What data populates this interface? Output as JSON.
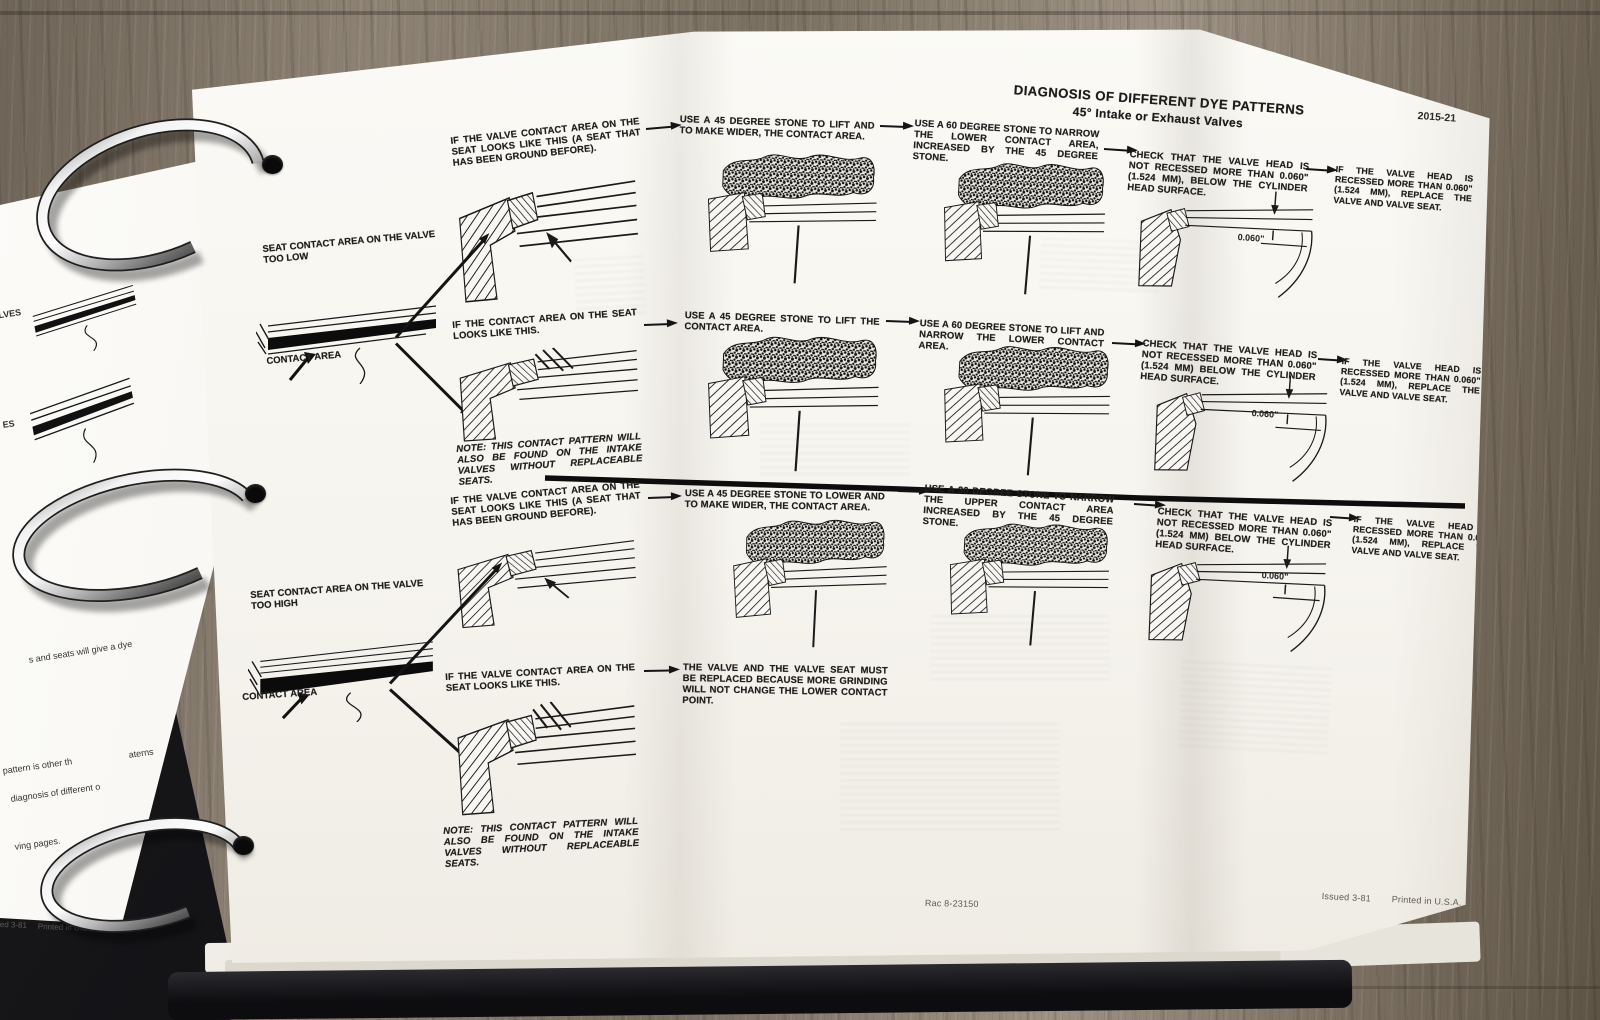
{
  "header": {
    "title": "DIAGNOSIS OF DIFFERENT DYE PATTERNS",
    "subtitle": "45° Intake or Exhaust Valves",
    "page_number": "2015-21"
  },
  "sections": {
    "too_low": {
      "label": "SEAT CONTACT AREA ON THE VALVE TOO LOW",
      "contact_label": "CONTACT AREA"
    },
    "too_high": {
      "label": "SEAT CONTACT AREA ON THE VALVE TOO HIGH",
      "contact_label": "CONTACT AREA"
    }
  },
  "flow": {
    "r1c1": "IF THE VALVE CONTACT AREA ON THE SEAT LOOKS LIKE THIS (A SEAT THAT HAS BEEN GROUND BEFORE).",
    "r1c2": "USE A 45 DEGREE STONE TO LIFT AND TO MAKE WIDER, THE CONTACT AREA.",
    "r1c3": "USE A 60 DEGREE STONE TO NARROW THE LOWER CONTACT AREA, INCREASED BY THE 45 DEGREE STONE.",
    "r1c4": "CHECK THAT THE VALVE HEAD IS NOT RECESSED MORE THAN 0.060\" (1.524 MM), BELOW THE CYLINDER HEAD SURFACE.",
    "r1c5": "IF THE VALVE HEAD IS RECESSED MORE THAN 0.060\" (1.524 MM), REPLACE THE VALVE AND VALVE SEAT.",
    "r2c1": "IF THE CONTACT AREA ON THE SEAT LOOKS LIKE THIS.",
    "r2c2": "USE A 45 DEGREE STONE TO LIFT THE CONTACT AREA.",
    "r2c3": "USE A 60 DEGREE STONE TO LIFT AND NARROW THE LOWER CONTACT AREA.",
    "r2c4": "CHECK THAT THE VALVE HEAD IS NOT RECESSED MORE THAN 0.060\" (1.524 MM) BELOW THE CYLINDER HEAD SURFACE.",
    "r2c5": "IF THE VALVE HEAD IS RECESSED MORE THAN 0.060\" (1.524 MM), REPLACE THE VALVE AND VALVE SEAT.",
    "note1": "NOTE: THIS CONTACT PATTERN WILL ALSO BE FOUND ON THE INTAKE VALVES WITHOUT REPLACEABLE SEATS.",
    "r3c1": "IF THE VALVE CONTACT AREA ON THE SEAT LOOKS LIKE THIS (A SEAT THAT HAS BEEN GROUND BEFORE).",
    "r3c2": "USE A 45 DEGREE STONE TO LOWER AND TO MAKE WIDER, THE CONTACT AREA.",
    "r3c3": "USE A 30 DEGREE STONE TO NARROW THE UPPER CONTACT AREA INCREASED BY THE 45 DEGREE STONE.",
    "r3c4": "CHECK THAT THE VALVE HEAD IS NOT RECESSED MORE THAN 0.060\" (1.524 MM) BELOW THE CYLINDER HEAD SURFACE.",
    "r3c5": "IF THE VALVE HEAD IS RECESSED MORE THAN 0.060\" (1.524 MM), REPLACE THE VALVE AND VALVE SEAT.",
    "r4c1": "IF THE VALVE CONTACT AREA ON THE SEAT LOOKS LIKE THIS.",
    "r4c2": "THE VALVE AND THE VALVE SEAT MUST BE REPLACED BECAUSE MORE GRINDING WILL NOT CHANGE THE LOWER CONTACT POINT.",
    "note2": "NOTE: THIS CONTACT PATTERN WILL ALSO BE FOUND ON THE INTAKE VALVES WITHOUT REPLACEABLE SEATS."
  },
  "dim_label": "0.060\"",
  "footer": {
    "doc_code": "Rac 8-23150",
    "issued": "Issued 3-81",
    "printed": "Printed in U.S.A."
  },
  "left_page": {
    "frag1": "VALVES",
    "frag2": "ES",
    "frag3": "s and seats will give a dye",
    "frag4": "pattern is other th",
    "frag5": "aterns",
    "frag6": "diagnosis of different o",
    "frag7": "ving pages.",
    "footer_issued": "ed 3-81",
    "footer_printed": "Printed in U.S.A."
  }
}
